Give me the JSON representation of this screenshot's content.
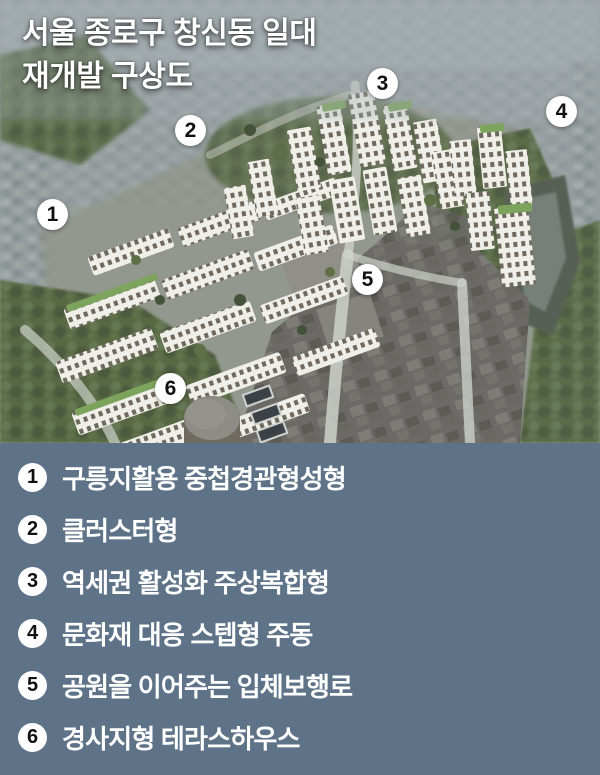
{
  "title": {
    "line1": "서울 종로구 창신동 일대",
    "line2": "재개발 구상도"
  },
  "map": {
    "markers": [
      {
        "number": "1",
        "x": 53,
        "y": 215
      },
      {
        "number": "2",
        "x": 191,
        "y": 131
      },
      {
        "number": "3",
        "x": 383,
        "y": 84
      },
      {
        "number": "4",
        "x": 562,
        "y": 112
      },
      {
        "number": "5",
        "x": 368,
        "y": 280
      },
      {
        "number": "6",
        "x": 171,
        "y": 389
      }
    ]
  },
  "legend": {
    "items": [
      {
        "number": "1",
        "label": "구릉지활용 중첩경관형성형"
      },
      {
        "number": "2",
        "label": "클러스터형"
      },
      {
        "number": "3",
        "label": "역세권 활성화 주상복합형"
      },
      {
        "number": "4",
        "label": "문화재 대응 스텝형 주동"
      },
      {
        "number": "5",
        "label": "공원을 이어주는 입체보행로"
      },
      {
        "number": "6",
        "label": "경사지형 테라스하우스"
      }
    ]
  },
  "colors": {
    "legend_background": "#5f7388",
    "marker_fill": "#ffffff",
    "marker_number": "#111111",
    "text": "#ffffff"
  }
}
